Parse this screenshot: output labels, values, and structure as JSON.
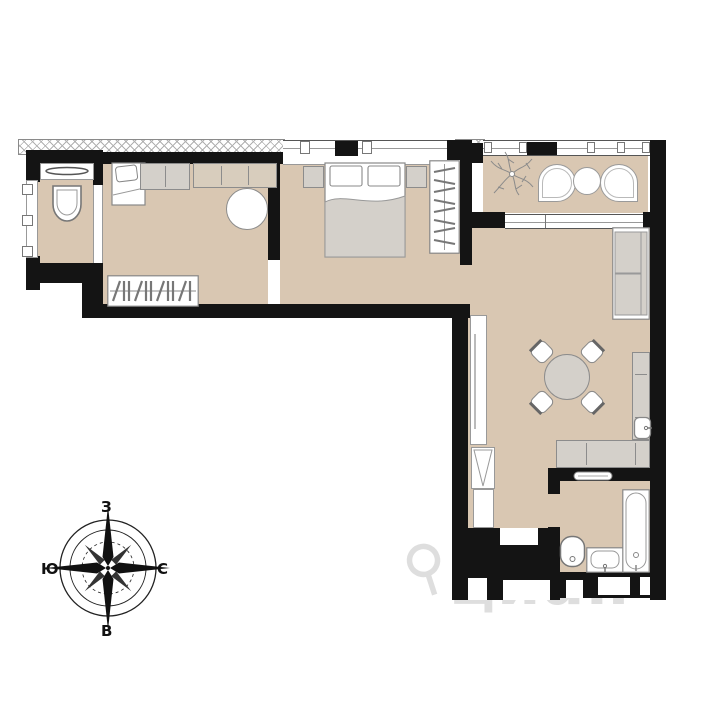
{
  "type": "floor-plan",
  "compass": {
    "top": "З",
    "left": "Ю",
    "right": "С",
    "bottom": "В"
  },
  "watermark": {
    "text": "циан",
    "icon": "map-pin-icon"
  },
  "colors": {
    "floor": "#d9c7b2",
    "wall": "#141414",
    "furniture_fill": "#d4d0ca",
    "furniture_outline": "#8c8c8c",
    "hatch_line": "#b0b0b0",
    "watermark": "#c9c9c9"
  },
  "rooms": [
    {
      "id": "wc",
      "furniture": [
        "washbasin-counter-icon",
        "toilet-icon"
      ]
    },
    {
      "id": "bedroom-small",
      "furniture": [
        "single-bed-icon",
        "wardrobe-icon",
        "round-table-icon",
        "coat-rack-icon"
      ]
    },
    {
      "id": "bedroom-master",
      "furniture": [
        "nightstand-icon",
        "double-bed-icon",
        "nightstand-icon",
        "open-wardrobe-icon"
      ]
    },
    {
      "id": "balcony",
      "furniture": [
        "plant-icon",
        "armchair-icon",
        "coffee-table-icon",
        "armchair-icon"
      ]
    },
    {
      "id": "living-kitchen",
      "furniture": [
        "sofa-icon",
        "dining-table-icon",
        "chair-icon",
        "chair-icon",
        "chair-icon",
        "chair-icon",
        "kitchen-counter-icon",
        "kitchen-sink-icon",
        "tv-stand-icon",
        "fridge-icon"
      ]
    },
    {
      "id": "bathroom",
      "furniture": [
        "towel-rail-icon",
        "toilet-icon",
        "washbasin-icon",
        "bathtub-icon"
      ]
    }
  ]
}
